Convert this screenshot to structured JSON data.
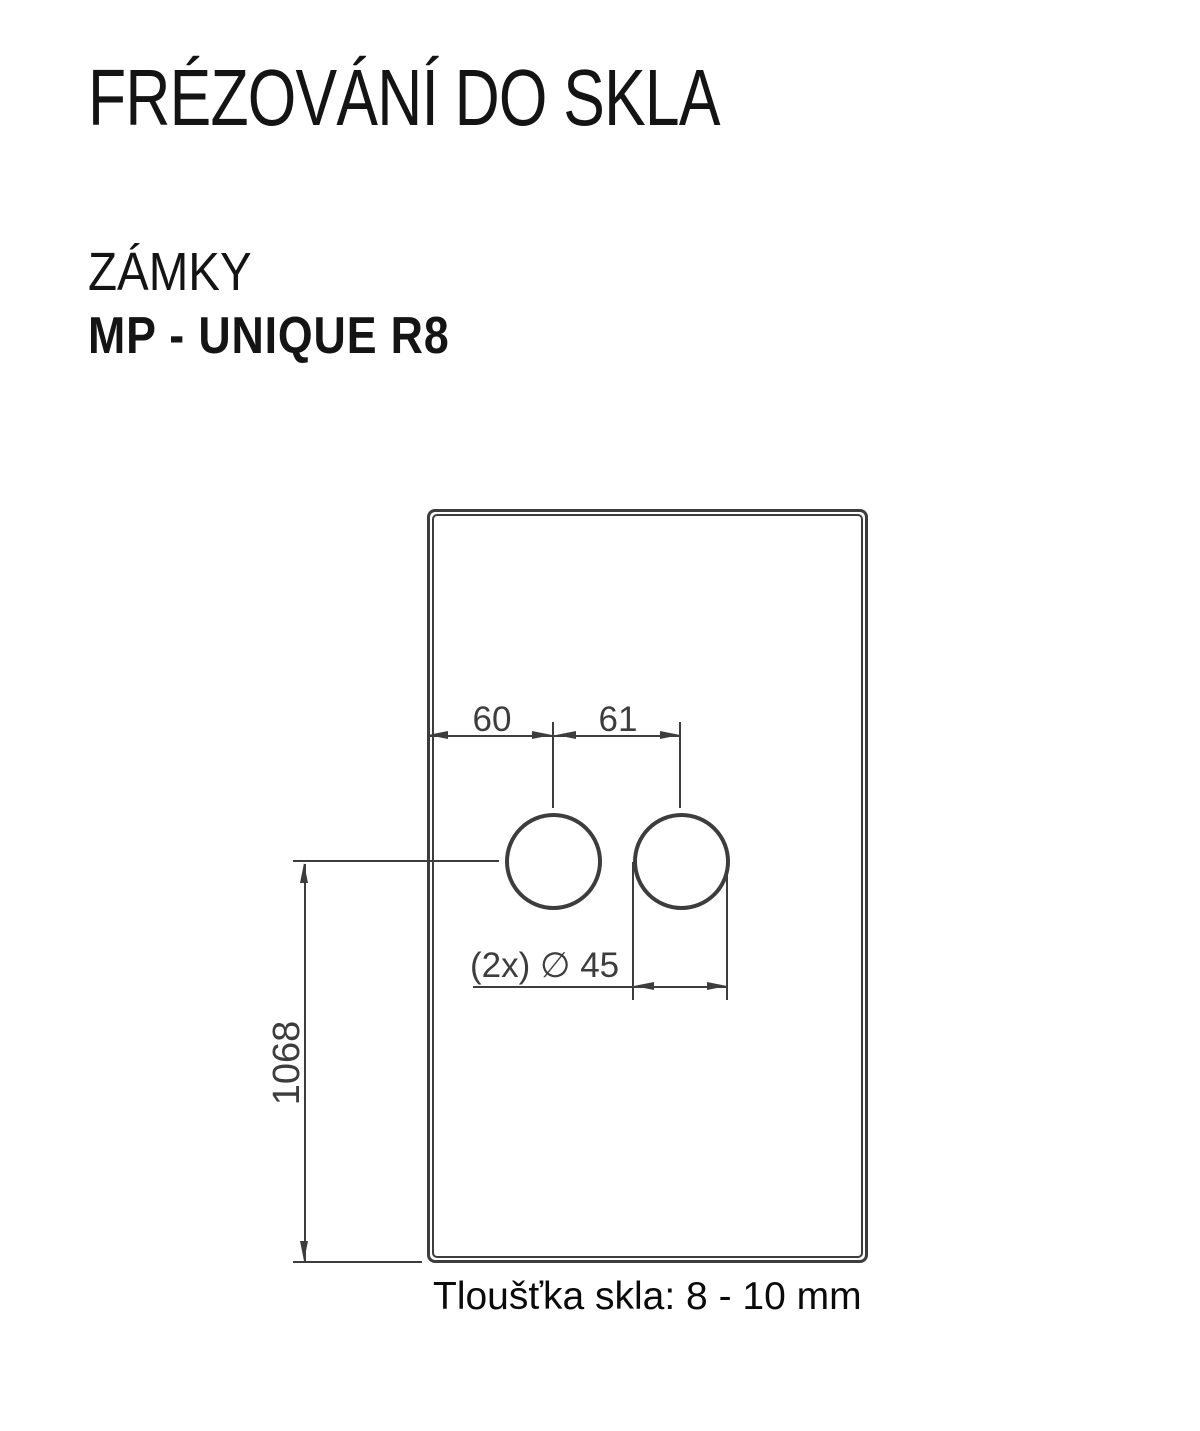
{
  "header": {
    "title": "FRÉZOVÁNÍ DO SKLA",
    "category": "ZÁMKY",
    "product": "MP - UNIQUE R8"
  },
  "drawing": {
    "labels": {
      "dim_left": "60",
      "dim_right": "61",
      "holes": "(2x) ∅ 45",
      "height": "1068"
    },
    "values": {
      "dim_left_mm": 60,
      "dim_right_mm": 61,
      "hole_diameter_mm": 45,
      "holes_count": 2,
      "height_mm": 1068
    }
  },
  "footer": {
    "thickness_note": "Tloušťka skla: 8 - 10 mm"
  },
  "colors": {
    "line": "#3d3d3d",
    "text": "#141414"
  }
}
